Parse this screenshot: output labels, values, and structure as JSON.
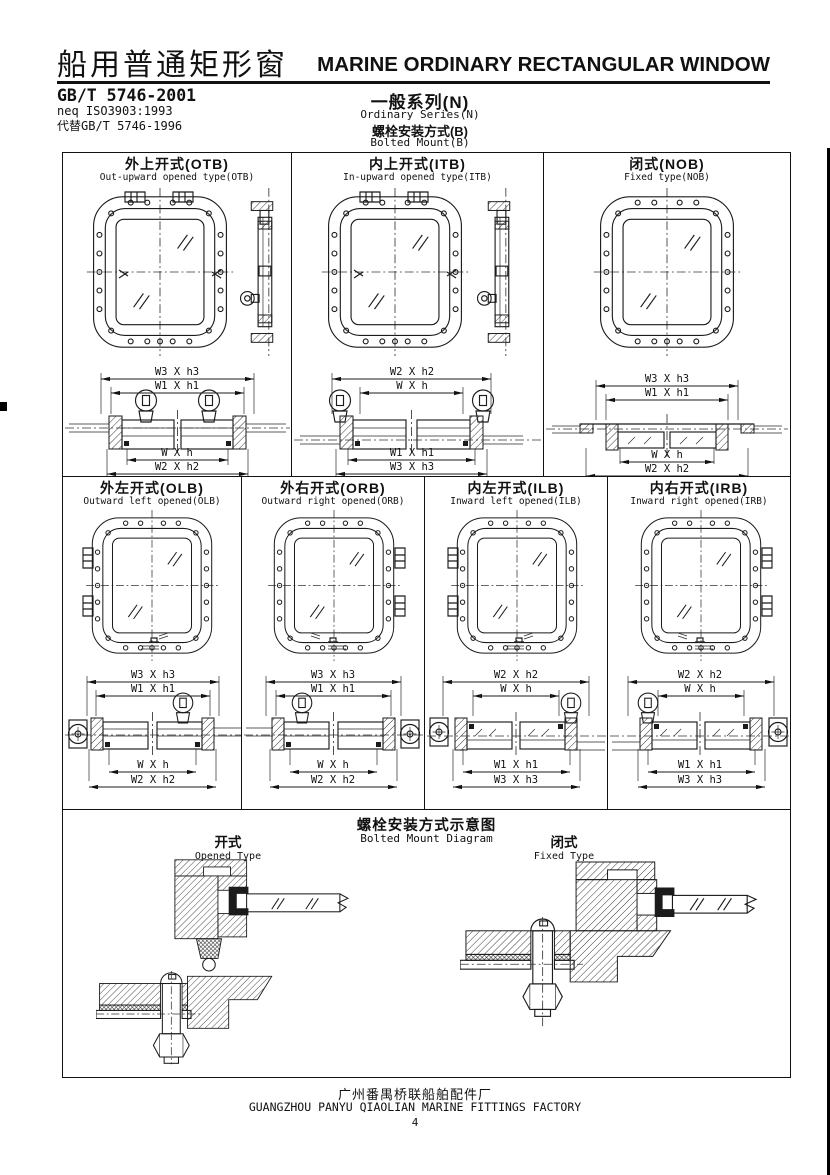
{
  "header": {
    "title_cn": "船用普通矩形窗",
    "title_en": "MARINE ORDINARY RECTANGULAR WINDOW",
    "standard": "GB/T 5746-2001",
    "standard_neq": "neq ISO3903:1993",
    "standard_replaces": "代替GB/T 5746-1996",
    "series_cn": "一般系列(N)",
    "series_en": "Ordinary Series(N)",
    "mount_cn": "螺栓安装方式(B)",
    "mount_en": "Bolted Mount(B)"
  },
  "row1": [
    {
      "title_cn": "外上开式(OTB)",
      "title_en": "Out-upward opened type(OTB)",
      "dim_top1": "W3 X h3",
      "dim_top2": "W1 X h1",
      "dim_bot1": "W X h",
      "dim_bot2": "W2 X h2"
    },
    {
      "title_cn": "内上开式(ITB)",
      "title_en": "In-upward opened type(ITB)",
      "dim_top1": "W2 X h2",
      "dim_top2": "W X h",
      "dim_bot1": "W1 X h1",
      "dim_bot2": "W3 X h3"
    },
    {
      "title_cn": "闭式(NOB)",
      "title_en": "Fixed type(NOB)",
      "dim_top1": "W3 X h3",
      "dim_top2": "W1 X h1",
      "dim_bot1": "W X h",
      "dim_bot2": "W2 X h2"
    }
  ],
  "row2": [
    {
      "title_cn": "外左开式(OLB)",
      "title_en": "Outward left opened(OLB)",
      "dim_top1": "W3 X h3",
      "dim_top2": "W1 X h1",
      "dim_bot1": "W X h",
      "dim_bot2": "W2 X h2"
    },
    {
      "title_cn": "外右开式(ORB)",
      "title_en": "Outward right opened(ORB)",
      "dim_top1": "W3 X h3",
      "dim_top2": "W1 X h1",
      "dim_bot1": "W X h",
      "dim_bot2": "W2 X h2"
    },
    {
      "title_cn": "内左开式(ILB)",
      "title_en": "Inward left opened(ILB)",
      "dim_top1": "W2 X h2",
      "dim_top2": "W X h",
      "dim_bot1": "W1 X h1",
      "dim_bot2": "W3 X h3"
    },
    {
      "title_cn": "内右开式(IRB)",
      "title_en": "Inward right opened(IRB)",
      "dim_top1": "W2 X h2",
      "dim_top2": "W X h",
      "dim_bot1": "W1 X h1",
      "dim_bot2": "W3 X h3"
    }
  ],
  "bottom": {
    "title_cn": "螺栓安装方式示意图",
    "title_en": "Bolted Mount Diagram",
    "left_cn": "开式",
    "left_en": "Opened Type",
    "right_cn": "闭式",
    "right_en": "Fixed Type"
  },
  "footer": {
    "factory_cn": "广州番禺桥联船舶配件厂",
    "factory_en": "GUANGZHOU PANYU QIAOLIAN MARINE FITTINGS FACTORY",
    "page": "4"
  }
}
